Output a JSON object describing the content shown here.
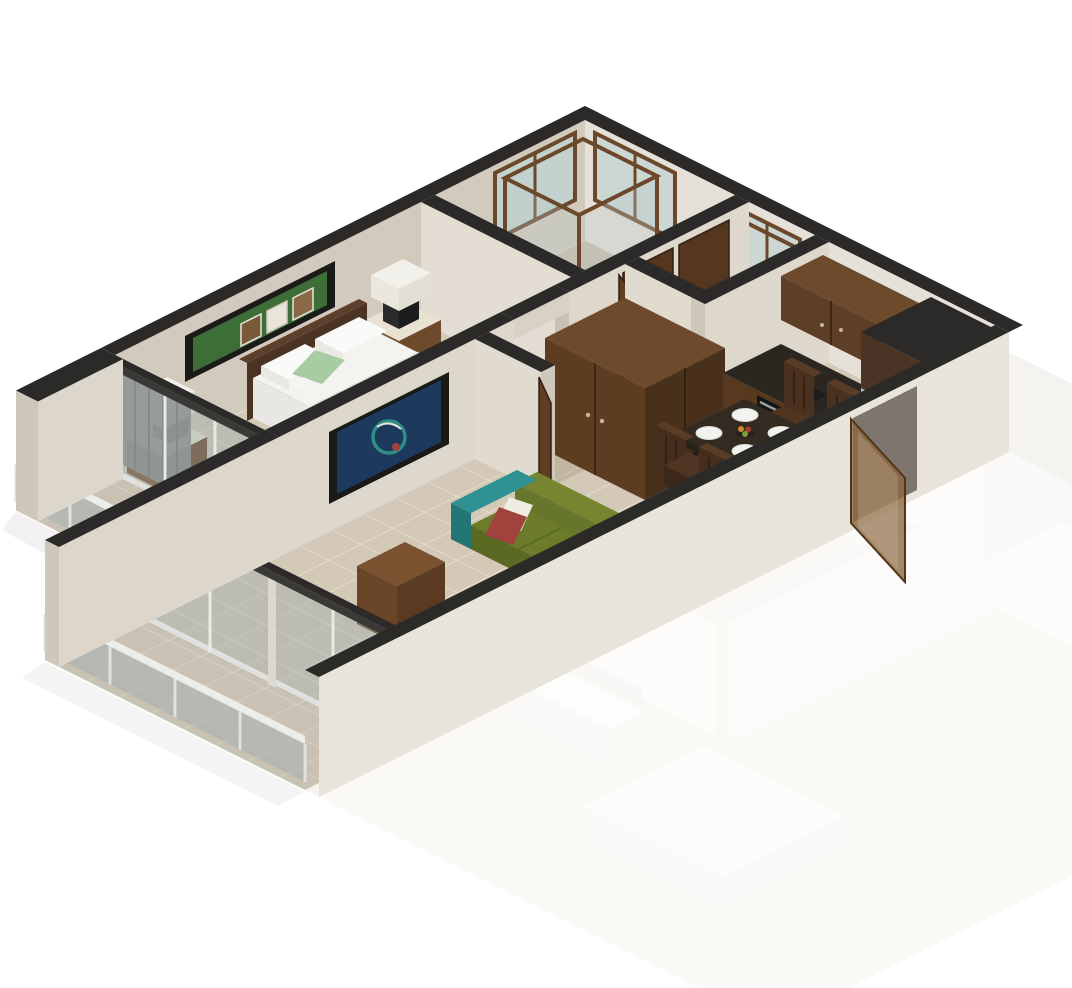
{
  "meta": {
    "title": "Isometric 3D cutaway floor plan of a one-bedroom apartment",
    "view": "axonometric cutaway render, white background",
    "adjacent_unit_style": "faded ghost render at lower right"
  },
  "palette": {
    "background": "#ffffff",
    "wall_top": "#2b2a28",
    "wall_face_light": "#e6e1d8",
    "wall_face_mid": "#d2cabc",
    "wall_exterior": "#e9e4db",
    "floor_tile": "#d3c9b6",
    "floor_grout": "#e9e2d3",
    "balcony_tile": "#c9c2b4",
    "balcony_grout": "#ddd7ca",
    "wood_dark": "#4a301b",
    "wood_mid": "#6e4a2c",
    "wood_light": "#8a5c33",
    "door_brown": "#54371e",
    "sofa_green": "#6d7c2b",
    "sofa_green_dark": "#5a6a23",
    "sofa_back_green": "#77862e",
    "sofa_teal": "#2f9191",
    "cushion_red": "#a2423c",
    "cushion_white": "#efece2",
    "bed_white": "#f4f3f0",
    "pillow_green": "#a7cba2",
    "headboard": "#4a3322",
    "table_black": "#332b22",
    "steel": "#b7babc",
    "glass_pane": "rgba(150,168,172,0.38)",
    "railing_glass": "rgba(160,172,175,0.5)",
    "curtain_gray": "#8f8e8b",
    "art_green": "#3e6e38",
    "art_blue": "#1d3a5c",
    "art_frame": "#1a1a18",
    "ceramic_white": "#f7f7f5",
    "tub_water": "#cfe2df",
    "ghost_floor": "#f2ece0",
    "ghost_wall": "#f6f4f0"
  },
  "scene": {
    "rooms": [
      {
        "name": "bedroom",
        "items": [
          "double bed",
          "headboard",
          "2 nightstands",
          "2 cube table lamps",
          "green wall art",
          "corner desk",
          "gray curtains",
          "sliding glass door"
        ]
      },
      {
        "name": "living-room",
        "items": [
          "olive sofa with teal armrests",
          "red and white cushions",
          "cream coffee table",
          "wood console",
          "blue abstract wall art",
          "sliding glass door"
        ]
      },
      {
        "name": "dining-area",
        "items": [
          "square dark wood table",
          "4 wood chairs",
          "4 white plates",
          "fruit centerpiece"
        ]
      },
      {
        "name": "kitchen",
        "items": [
          "walnut upper cabinet",
          "base counter with oven",
          "tall unit with steel refrigerator front"
        ]
      },
      {
        "name": "bathroom-main",
        "items": [
          "wood framed shower enclosure",
          "bathtub",
          "toilet",
          "corner windows"
        ]
      },
      {
        "name": "bathroom-second",
        "items": [
          "wood framed shower",
          "toilet",
          "window"
        ]
      },
      {
        "name": "hallway",
        "items": [
          "wardrobe",
          "closet doors",
          "open door"
        ]
      },
      {
        "name": "bedroom-balcony",
        "items": [
          "glass railing",
          "end pillar"
        ]
      },
      {
        "name": "living-balcony",
        "items": [
          "glass railing"
        ]
      },
      {
        "name": "adjacent-unit",
        "items": [
          "faded bed",
          "faded tv console",
          "faded partition walls"
        ]
      }
    ]
  }
}
